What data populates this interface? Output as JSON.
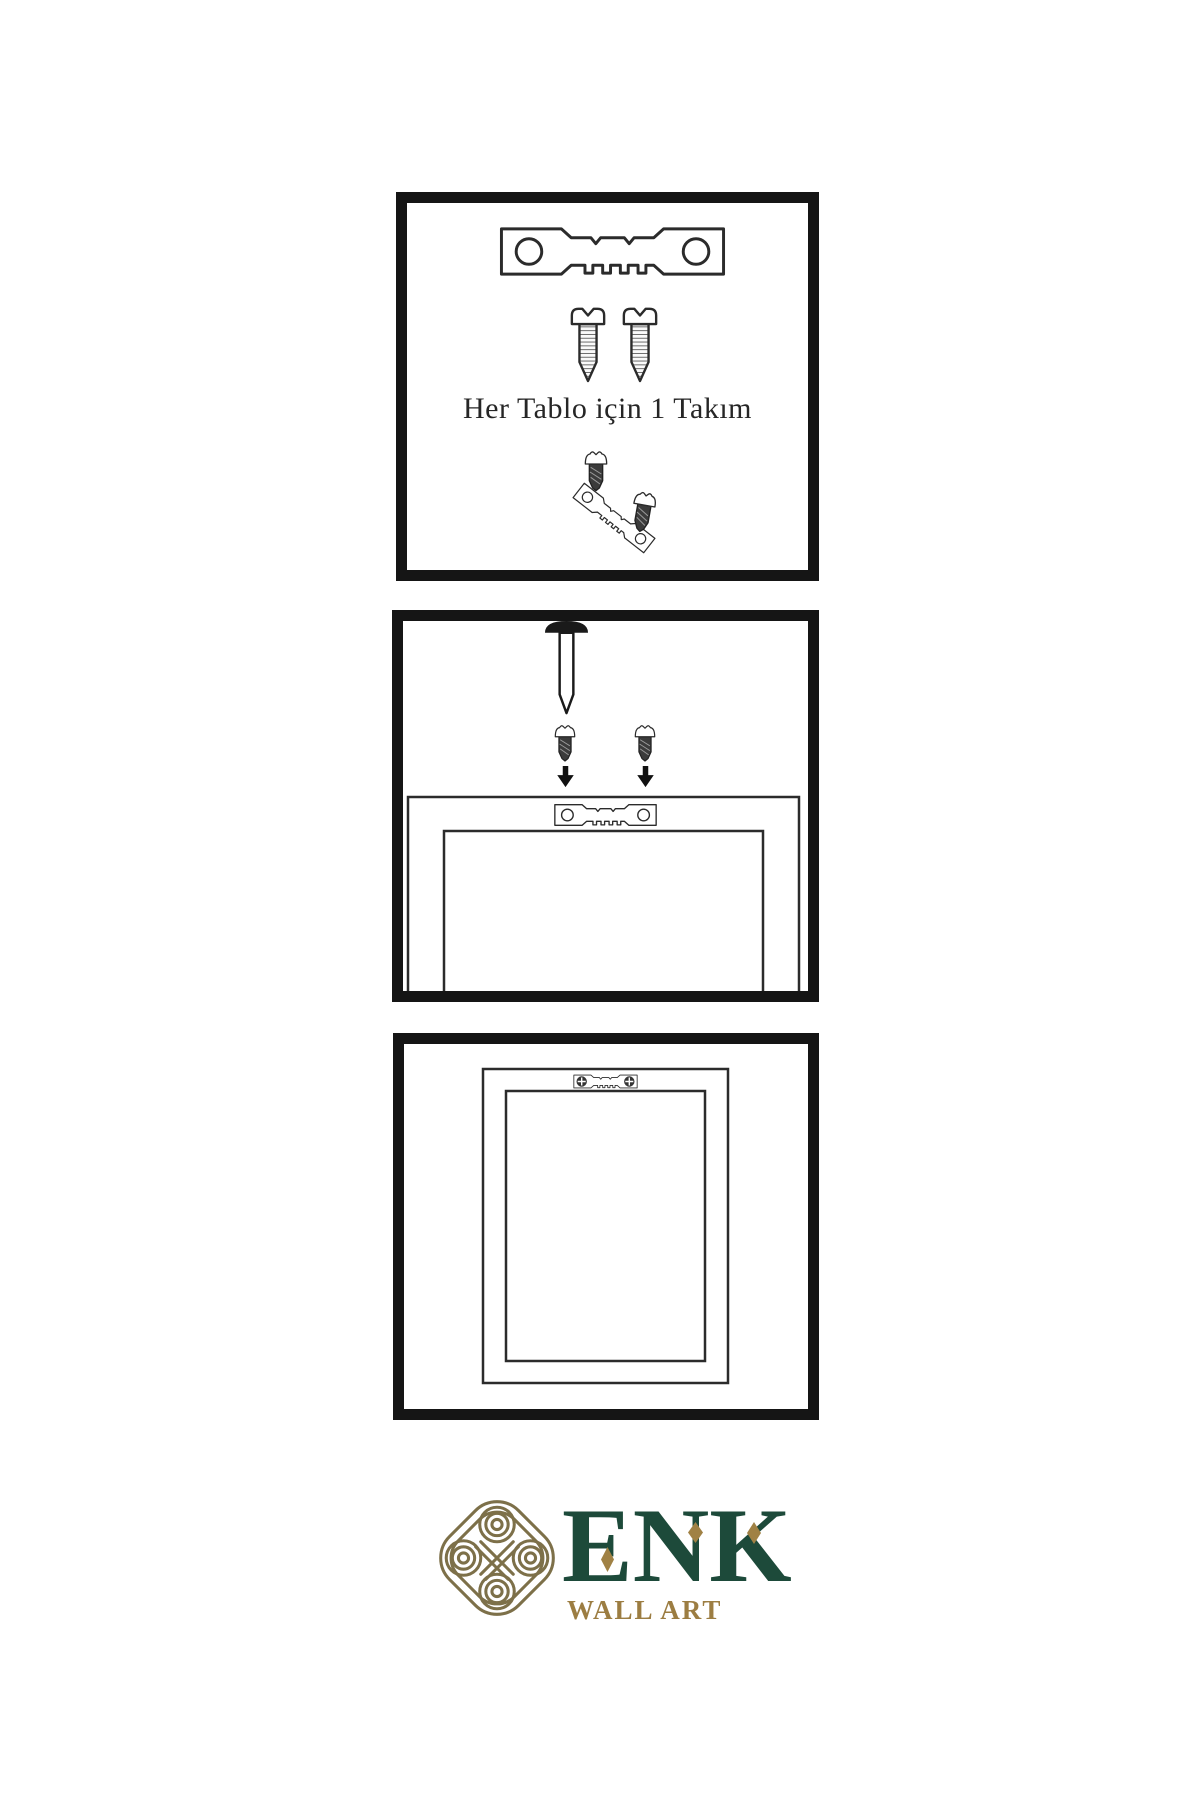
{
  "page": {
    "background_color": "#ffffff"
  },
  "panels": [
    {
      "id": "hardware-kit",
      "caption": "Her Tablo için 1 Takım",
      "items": [
        "sawtooth-hanger",
        "screw",
        "screw",
        "screw-dark",
        "sawtooth-hanger-tilted",
        "screw-dark"
      ]
    },
    {
      "id": "mounting-instructions",
      "caption": "",
      "items": [
        "wall-nail",
        "screw-dark",
        "screw-dark",
        "arrow-down",
        "arrow-down",
        "sawtooth-hanger",
        "frame-back"
      ]
    },
    {
      "id": "hung-frame",
      "caption": "",
      "items": [
        "frame-back",
        "sawtooth-hanger-installed"
      ]
    }
  ],
  "logo": {
    "brand": "ENK",
    "subtitle": "WALL ART"
  },
  "icons": {
    "sawtooth-hanger": "svg-shape",
    "screw": "svg-shape",
    "screw-dark": "svg-shape",
    "wall-nail": "svg-shape",
    "arrow-down": "▼",
    "knot-logo": "svg-shape",
    "diamond-accent": "◆"
  },
  "colors": {
    "panel_border": "#151515",
    "line": "#2b2b2b",
    "screw_dark_fill": "#3b3b3b",
    "brand_green": "#1d4a3a",
    "brand_gold": "#9c7d42",
    "knot_gold": "#7d7049",
    "caption_text": "#262626"
  }
}
